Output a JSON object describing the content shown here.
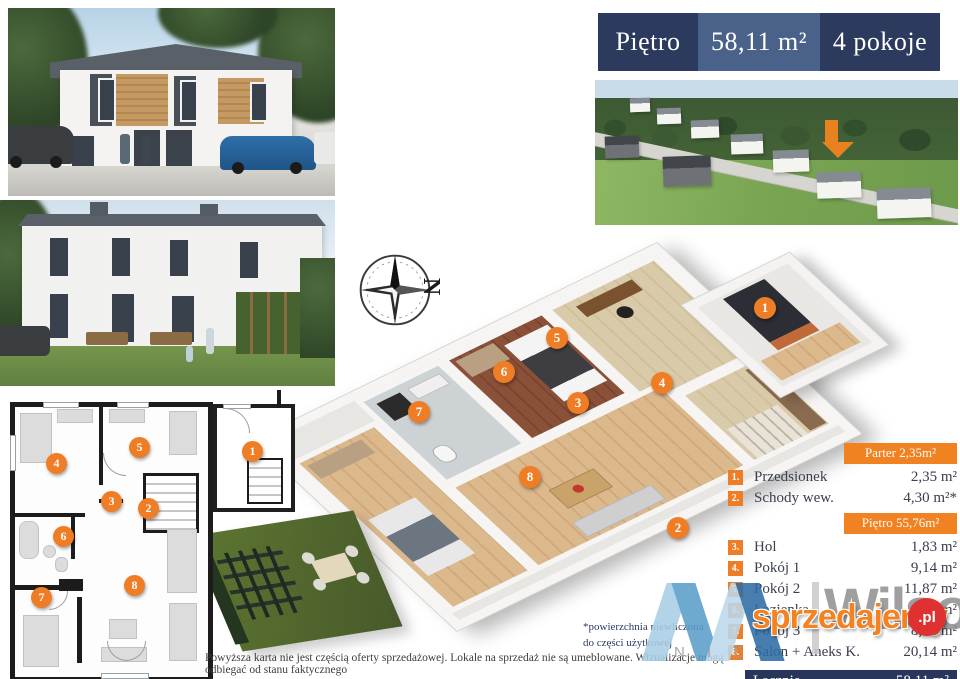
{
  "banner": {
    "floor_label": "Piętro",
    "area_label": "58,11 m²",
    "rooms_label": "4 pokoje"
  },
  "compass": {
    "north_label": "N"
  },
  "plan_markers": [
    "1",
    "2",
    "3",
    "4",
    "5",
    "6",
    "7",
    "8"
  ],
  "legend": {
    "parter_header": "Parter 2,35m²",
    "pietro_header": "Piętro 55,76m²",
    "rows": [
      {
        "num": "1.",
        "label": "Przedsionek",
        "area": "2,35 m²"
      },
      {
        "num": "2.",
        "label": "Schody wew.",
        "area": "4,30 m²*"
      },
      {
        "num": "3.",
        "label": "Hol",
        "area": "1,83 m²"
      },
      {
        "num": "4.",
        "label": "Pokój 1",
        "area": "9,14 m²"
      },
      {
        "num": "5.",
        "label": "Pokój 2",
        "area": "11,87 m²"
      },
      {
        "num": "6.",
        "label": "Łazienka",
        "area": "4,75 m²"
      },
      {
        "num": "7.",
        "label": "Pokój 3",
        "area": "8,03 m²"
      },
      {
        "num": "8.",
        "label": "Salon + Aneks K.",
        "area": "20,14 m²"
      }
    ],
    "total": {
      "label": "Łącznie",
      "area": "58,11 m²"
    }
  },
  "footnote": {
    "line1": "*powierzchnia niewliczona",
    "line2": "do części użytkowej"
  },
  "disclaimer": "Powyższa karta nie jest częścią oferty sprzedażowej. Lokale na sprzedaż nie są umeblowane. Wizualizacje mogą odbiegać od stanu faktycznego",
  "watermark": {
    "brand": "Wilsons",
    "brand_letters": "N I E",
    "portal": "sprzedajemy",
    "portal_badge": ".pl"
  },
  "colors": {
    "accent_orange": "#ee7d25",
    "header_orange": "#f08222",
    "navy": "#27365a",
    "navy_mid": "#4a6289"
  }
}
